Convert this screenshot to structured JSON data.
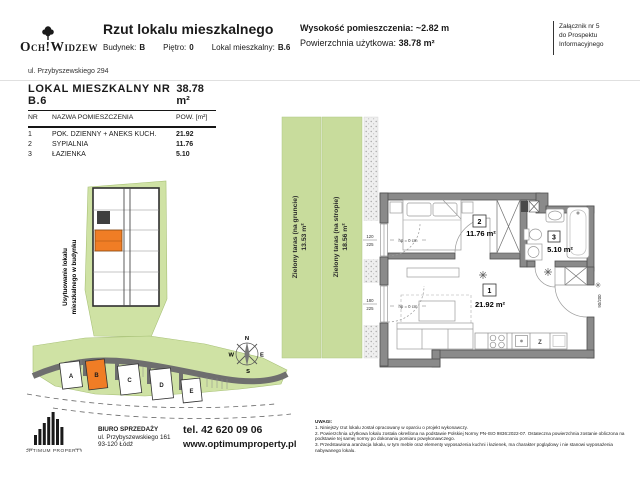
{
  "colors": {
    "highlight_orange": "#F07D25",
    "terrace_green": "#C8DC9C",
    "site_green": "#CFE2A4",
    "wall_gray": "#8A8A8A"
  },
  "header": {
    "brand": "Och!Widzew",
    "title": "Rzut lokalu mieszkalnego",
    "building_label": "Budynek:",
    "building_value": "B",
    "floor_label": "Piętro:",
    "floor_value": "0",
    "unit_label": "Lokal mieszkalny:",
    "unit_value": "B.6",
    "height_label": "Wysokość pomieszczenia:",
    "height_value": "~2.82 m",
    "area_label": "Powierzchnia użytkowa:",
    "area_value": "38.78 m²",
    "attachment": [
      "Załącznik nr 5",
      "do Prospektu",
      "Informacyjnego"
    ]
  },
  "address": "ul. Przybyszewskiego 294",
  "unit_table": {
    "title": "LOKAL MIESZKALNY NR B.6",
    "total_area": "38.78 m²",
    "columns": [
      "NR",
      "NAZWA POMIESZCZENIA",
      "POW. [m²]"
    ],
    "rows": [
      {
        "nr": "1",
        "name": "POK. DZIENNY + ANEKS KUCH.",
        "area": "21.92"
      },
      {
        "nr": "2",
        "name": "SYPIALNIA",
        "area": "11.76"
      },
      {
        "nr": "3",
        "name": "ŁAZIENKA",
        "area": "5.10"
      }
    ]
  },
  "locator": {
    "caption_line1": "Usytuowanie lokalu",
    "caption_line2": "mieszkalnego w budynku"
  },
  "floor_plan": {
    "terraces": [
      {
        "label": "Zielony taras (na gruncie)",
        "area": "13.53 m²"
      },
      {
        "label": "Zielony taras (na stropie)",
        "area": "18.56 m²"
      }
    ],
    "rooms": [
      {
        "nr": "1",
        "area": "21.92 m²"
      },
      {
        "nr": "2",
        "area": "11.76 m²"
      },
      {
        "nr": "3",
        "area": "5.10 m²"
      }
    ],
    "windows": [
      {
        "width": "120",
        "height": "225",
        "hp": "hp = 0 cm"
      },
      {
        "width": "180",
        "height": "225",
        "hp": "hp = 0 cm"
      }
    ],
    "entry_dim": "90/200",
    "kitchen_label": "Z"
  },
  "site_plan": {
    "buildings": [
      "A",
      "B",
      "C",
      "D",
      "E"
    ],
    "highlighted": "B",
    "compass": {
      "n": "N",
      "e": "E",
      "s": "S",
      "w": "W"
    }
  },
  "footer": {
    "logo_text": "OPTIMUM PROPERTY",
    "office_title": "BIURO SPRZEDAŻY",
    "office_line1": "ul. Przybyszewskiego 161",
    "office_line2": "93-120 Łódź",
    "phone": "tel. 42 620 09 06",
    "website": "www.optimumproperty.pl",
    "notes_title": "UWAGI:",
    "notes": [
      "1. Niniejszy rzut lokalu został opracowany w oparciu o projekt wykonawczy.",
      "2. Powierzchnia użytkowa lokalu została określona na podstawie Polskiej Normy PN-ISO 9836:2022-07. Ostateczna powierzchnia zostanie obliczona na podstawie tej samej normy po dokonaniu pomiaru powykonawczego.",
      "3. Przedstawiona aranżacja lokalu, w tym meble oraz elementy wyposażenia kuchni i łazienek, ma charakter poglądowy i nie stanowi wyposażenia nabywanego lokalu."
    ]
  }
}
